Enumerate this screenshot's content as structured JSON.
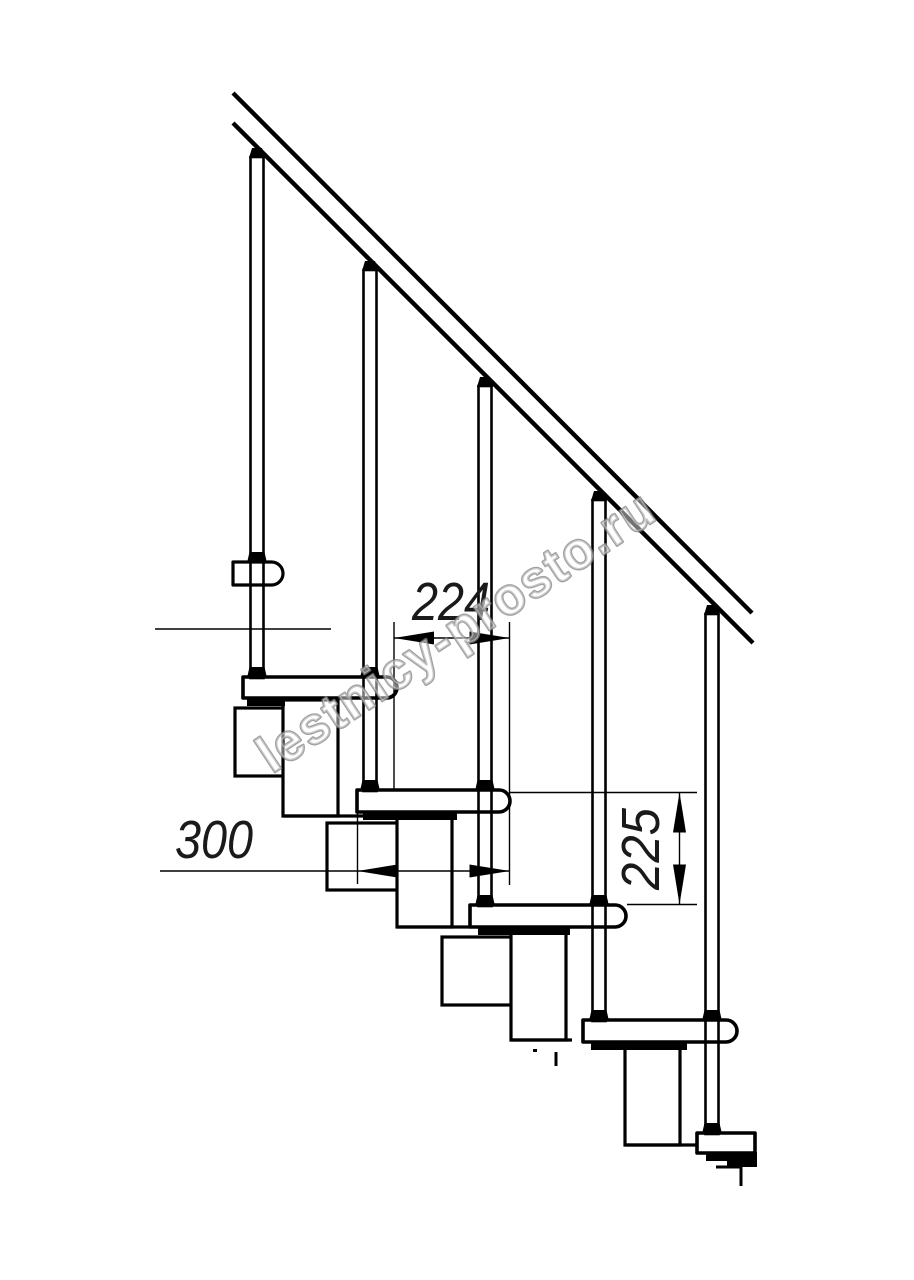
{
  "title": "Modular staircase side-view fragment drawing",
  "canvas": {
    "width": 914,
    "height": 1280,
    "background": "#ffffff",
    "line_color": "#000000"
  },
  "watermark": {
    "text": "lestnicy-prosto.ru",
    "x": 272,
    "y": 774,
    "angle": -33.5,
    "font_size": 52,
    "text_length": 465,
    "fill": "rgba(255,255,255,0.45)",
    "outline": "rgba(130,130,130,0.75)"
  },
  "dimensions": [
    {
      "id": "tread-pitch",
      "label": "224",
      "orient": "h",
      "line": [
        394,
        638,
        509.5,
        638
      ],
      "arrows": [
        [
          "left",
          394,
          638
        ],
        [
          "right",
          509.5,
          638
        ]
      ],
      "exts": [
        [
          394,
          622,
          394,
          790
        ],
        [
          509.5,
          622,
          509.5,
          885
        ]
      ],
      "label_x": 451,
      "label_y": 620,
      "text_length": 78
    },
    {
      "id": "tread-depth",
      "label": "300",
      "orient": "h",
      "line": [
        160,
        871,
        509.5,
        871
      ],
      "arrows": [
        [
          "left",
          357.5,
          871
        ],
        [
          "right",
          509.5,
          871
        ]
      ],
      "exts": [
        [
          357.5,
          812,
          357.5,
          884
        ]
      ],
      "label_x": 214,
      "label_y": 858,
      "text_length": 78
    },
    {
      "id": "riser-height",
      "label": "225",
      "orient": "v",
      "line": [
        679.5,
        792.5,
        679.5,
        904.5
      ],
      "arrows": [
        [
          "up",
          679.5,
          792.5
        ],
        [
          "down",
          679.5,
          904.5
        ]
      ],
      "exts": [
        [
          510,
          792.5,
          697,
          792.5
        ],
        [
          627,
          904.5,
          697,
          904.5
        ]
      ],
      "label_x": 659,
      "label_y": 849,
      "text_length": 82
    }
  ],
  "drawing": {
    "handrail": {
      "x1": 233,
      "y1": 93,
      "x2": 752,
      "y2": 613,
      "band": 30,
      "stroke": 4.4
    },
    "balusters": [
      {
        "axis": 257,
        "top": 148,
        "bottom": 677,
        "pass_collars": [
          562
        ],
        "base_collar": 677
      },
      {
        "axis": 370,
        "top": 261,
        "bottom": 790,
        "pass_collars": [
          677
        ],
        "base_collar": 790
      },
      {
        "axis": 485,
        "top": 377,
        "bottom": 905,
        "pass_collars": [
          790
        ],
        "base_collar": 905
      },
      {
        "axis": 599,
        "top": 491,
        "bottom": 1020,
        "pass_collars": [
          905
        ],
        "base_collar": 1020
      },
      {
        "axis": 712,
        "top": 605,
        "bottom": 1133,
        "pass_collars": [
          1020
        ],
        "base_collar": 1133
      }
    ],
    "steps": [
      {
        "x": 243,
        "y": 677,
        "w": 154,
        "h": 21,
        "cap": true,
        "strip_x": 247,
        "strip_w": 38
      },
      {
        "x": 357,
        "y": 790,
        "w": 153,
        "h": 22,
        "cap": true,
        "strip_x": 363,
        "strip_w": 94
      },
      {
        "x": 470,
        "y": 905,
        "w": 156,
        "h": 22,
        "cap": true,
        "strip_x": 478,
        "strip_w": 92
      },
      {
        "x": 583,
        "y": 1020,
        "w": 154,
        "h": 22,
        "cap": true,
        "strip_x": 591,
        "strip_w": 96
      },
      {
        "x": 697,
        "y": 1133,
        "w": 58,
        "h": 20,
        "cap": false,
        "strip_x": 706,
        "strip_w": 28
      }
    ],
    "rail_bracket": {
      "x": 233,
      "y": 562,
      "w": 50,
      "h": 23
    },
    "columns": [
      {
        "x": 283,
        "top": 700,
        "bottom": 816,
        "shelf_to": 411
      },
      {
        "x": 397,
        "top": 813,
        "bottom": 927,
        "shelf_to": 470
      },
      {
        "x": 511,
        "top": 928,
        "bottom": 1040,
        "shelf_to": 572
      },
      {
        "x": 625,
        "top": 1043,
        "bottom": 1145,
        "shelf_to": 755
      }
    ],
    "column_w": 55,
    "boxes": [
      {
        "x": 235,
        "y": 708,
        "w": 55,
        "h": 68
      },
      {
        "x": 327,
        "y": 823,
        "w": 76,
        "h": 67
      },
      {
        "x": 442,
        "y": 937,
        "w": 76,
        "h": 68
      }
    ],
    "ticks": [
      [
        556,
        1052,
        556,
        1066
      ]
    ],
    "bg_lines": [
      [
        155,
        629,
        331,
        629
      ]
    ],
    "hook": [
      [
        716,
        1167
      ],
      [
        741,
        1167
      ],
      [
        741,
        1186
      ]
    ],
    "blob": {
      "x": 727,
      "y": 1152,
      "w": 30,
      "h": 15
    },
    "speck": [
      533,
      1049
    ]
  }
}
